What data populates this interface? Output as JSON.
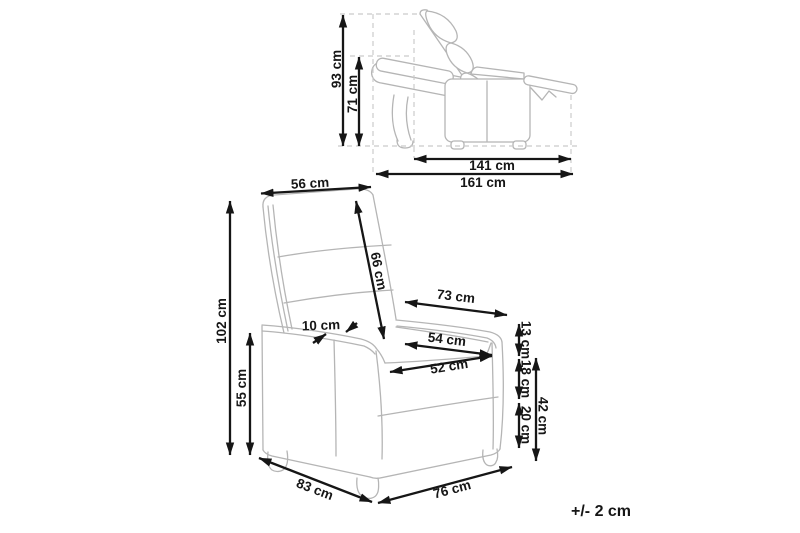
{
  "page": {
    "background": "#ffffff",
    "drawing_line_color": "#b5b5b5",
    "dimension_color": "#161616",
    "tolerance_note": "+/- 2 cm"
  },
  "side_view": {
    "dimensions": {
      "reclined_total_height": "93 cm",
      "reclined_backrest_height": "71 cm",
      "reclined_inner_depth": "141 cm",
      "reclined_total_depth": "161 cm"
    }
  },
  "front_view": {
    "dimensions": {
      "backrest_top_width": "56 cm",
      "backrest_length": "66 cm",
      "total_height": "102 cm",
      "armrest_height": "55 cm",
      "armrest_top_width": "10 cm",
      "width_armrest_outer": "73 cm",
      "seat_width_back": "54 cm",
      "seat_width_front": "52 cm",
      "armrest_above_seat": "13 cm",
      "seat_cushion_thickness": "18 cm",
      "base_height": "20 cm",
      "seat_height": "42 cm",
      "base_depth": "83 cm",
      "base_width": "76 cm"
    }
  }
}
